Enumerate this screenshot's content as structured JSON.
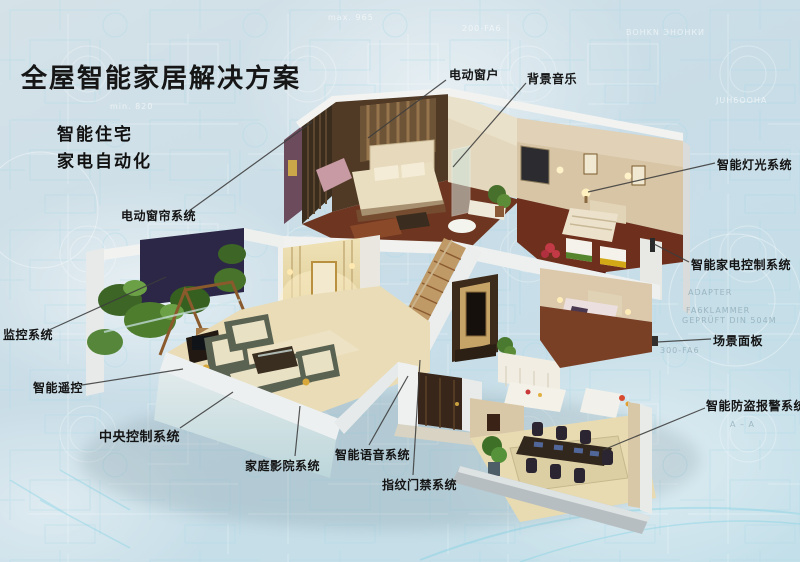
{
  "poster": {
    "title": "全屋智能家居解决方案",
    "subtitles": [
      "智能住宅",
      "家电自动化"
    ]
  },
  "callouts": [
    {
      "id": "electric-window",
      "label": "电动窗户",
      "lx": 449,
      "ly": 66,
      "x1": 446,
      "y1": 80,
      "x2": 368,
      "y2": 138
    },
    {
      "id": "background-music",
      "label": "背景音乐",
      "lx": 527,
      "ly": 70,
      "x1": 526,
      "y1": 83,
      "x2": 453,
      "y2": 167
    },
    {
      "id": "smart-lighting",
      "label": "智能灯光系统",
      "lx": 717,
      "ly": 156,
      "x1": 715,
      "y1": 163,
      "x2": 588,
      "y2": 192
    },
    {
      "id": "smart-appliance-control",
      "label": "智能家电控制系统",
      "lx": 691,
      "ly": 256,
      "x1": 689,
      "y1": 262,
      "x2": 654,
      "y2": 244
    },
    {
      "id": "scene-panel",
      "label": "场景面板",
      "lx": 713,
      "ly": 332,
      "x1": 711,
      "y1": 339,
      "x2": 657,
      "y2": 342
    },
    {
      "id": "burglar-alarm",
      "label": "智能防盗报警系统",
      "lx": 706,
      "ly": 397,
      "x1": 705,
      "y1": 408,
      "x2": 603,
      "y2": 450
    },
    {
      "id": "electric-curtain",
      "label": "电动窗帘系统",
      "lx": 121,
      "ly": 207,
      "x1": 189,
      "y1": 211,
      "x2": 312,
      "y2": 122
    },
    {
      "id": "surveillance",
      "label": "监控系统",
      "lx": 3,
      "ly": 326,
      "x1": 49,
      "y1": 330,
      "x2": 166,
      "y2": 277
    },
    {
      "id": "smart-remote",
      "label": "智能遥控",
      "lx": 33,
      "ly": 379,
      "x1": 82,
      "y1": 385,
      "x2": 183,
      "y2": 369
    },
    {
      "id": "central-control",
      "label": "中央控制系统",
      "lx": 99,
      "ly": 426,
      "fs": 13,
      "x1": 180,
      "y1": 428,
      "x2": 233,
      "y2": 392
    },
    {
      "id": "home-theater",
      "label": "家庭影院系统",
      "lx": 245,
      "ly": 457,
      "x1": 295,
      "y1": 456,
      "x2": 300,
      "y2": 406
    },
    {
      "id": "smart-voice",
      "label": "智能语音系统",
      "lx": 335,
      "ly": 446,
      "x1": 369,
      "y1": 445,
      "x2": 408,
      "y2": 376
    },
    {
      "id": "fingerprint-access",
      "label": "指纹门禁系统",
      "lx": 382,
      "ly": 476,
      "x1": 413,
      "y1": 475,
      "x2": 420,
      "y2": 360
    }
  ],
  "background": {
    "base_color": "#c9dde7",
    "blueprint_line_color": "#9fd3e3",
    "texts": [
      {
        "text": "max. 965",
        "x": 328,
        "y": 13,
        "dim": false
      },
      {
        "text": "min. 820",
        "x": 110,
        "y": 102,
        "dim": false
      },
      {
        "text": "200-FA6",
        "x": 462,
        "y": 24,
        "dim": false
      },
      {
        "text": "BOHKN ЭНОНКИ",
        "x": 626,
        "y": 28,
        "dim": false
      },
      {
        "text": "JUH6OOHA",
        "x": 716,
        "y": 96,
        "dim": false
      },
      {
        "text": "ADAPTER",
        "x": 688,
        "y": 288,
        "dim": true
      },
      {
        "text": "FA6KLAMMER",
        "x": 686,
        "y": 306,
        "dim": true
      },
      {
        "text": "GEPRÜFT DIN 504M",
        "x": 682,
        "y": 316,
        "dim": true
      },
      {
        "text": "300-FA6",
        "x": 660,
        "y": 346,
        "dim": true
      },
      {
        "text": "A – A",
        "x": 730,
        "y": 420,
        "dim": true
      }
    ]
  },
  "colors": {
    "label_text": "#141414",
    "callout_line": "#3d3d3d",
    "title_text": "#161616"
  }
}
